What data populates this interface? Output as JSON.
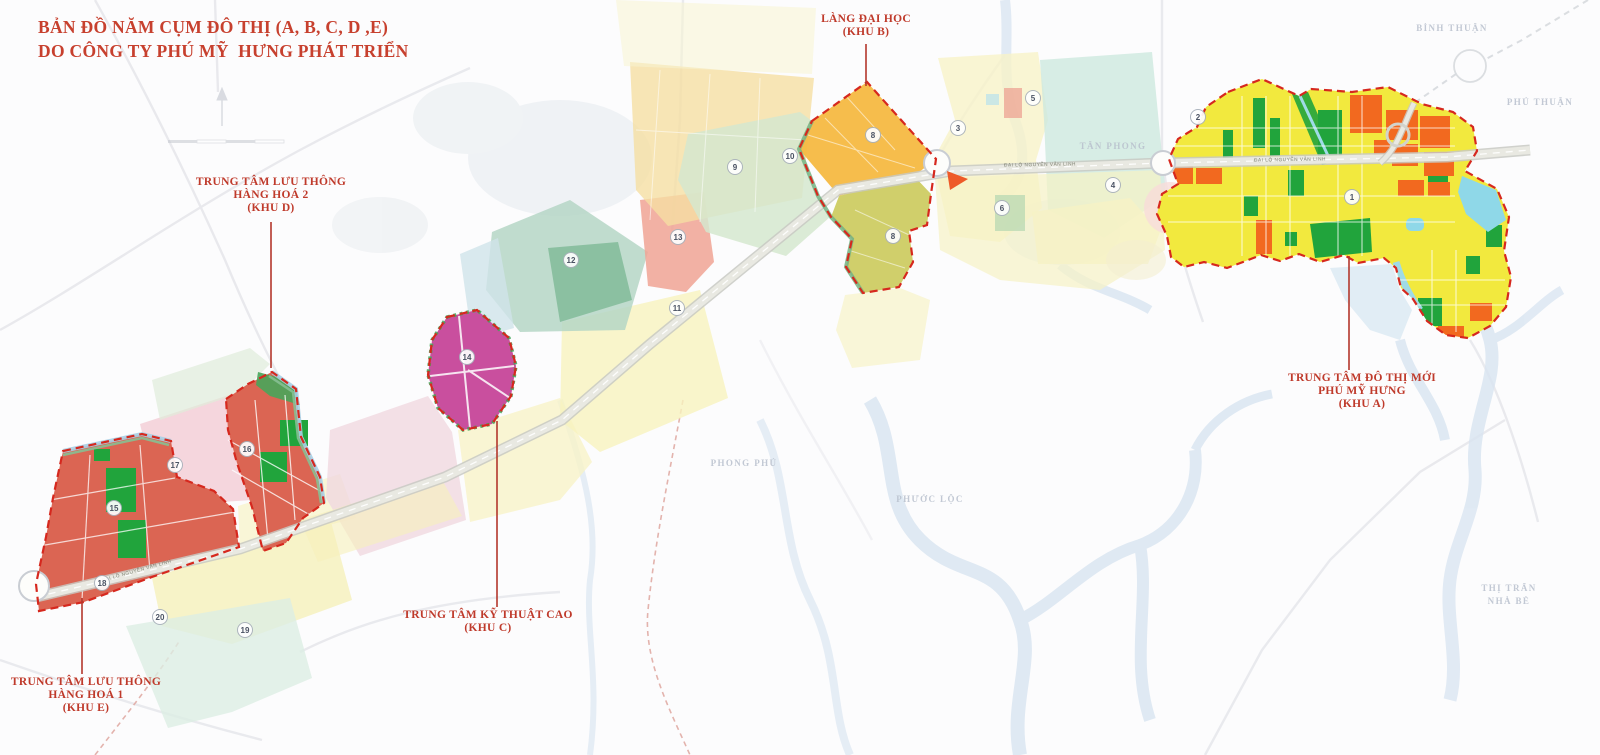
{
  "title": {
    "line1": "BẢN ĐỒ NĂM CỤM ĐÔ THỊ (A, B, C, D ,E)",
    "line2": "DO CÔNG TY PHÚ MỸ  HƯNG PHÁT TRIỂN"
  },
  "zone_labels": [
    {
      "id": "khu-b",
      "lines": [
        "LÀNG ĐẠI HỌC",
        "(KHU B)"
      ],
      "cx": 866,
      "top": 13,
      "leader": {
        "x": 866,
        "y1": 44,
        "y2": 86
      }
    },
    {
      "id": "khu-d",
      "lines": [
        "TRUNG TÂM LƯU THÔNG",
        "HÀNG HOÁ 2",
        "(KHU D)"
      ],
      "cx": 271,
      "top": 176,
      "leader": {
        "x": 271,
        "y1": 222,
        "y2": 368
      }
    },
    {
      "id": "khu-a",
      "lines": [
        "TRUNG TÂM ĐÔ THỊ MỚI",
        "PHÚ MỸ HƯNG",
        "(KHU A)"
      ],
      "cx": 1362,
      "top": 372,
      "leader": {
        "x": 1349,
        "y1": 256,
        "y2": 370
      }
    },
    {
      "id": "khu-c",
      "lines": [
        "TRUNG TÂM KỸ THUẬT CAO",
        "(KHU C)"
      ],
      "cx": 488,
      "top": 609,
      "leader": {
        "x": 497,
        "y1": 421,
        "y2": 607
      }
    },
    {
      "id": "khu-e",
      "lines": [
        "TRUNG TÂM LƯU THÔNG",
        "HÀNG HOÁ 1",
        "(KHU E)"
      ],
      "cx": 86,
      "top": 676,
      "leader": {
        "x": 82,
        "y1": 598,
        "y2": 674
      }
    }
  ],
  "district_names": [
    {
      "text": "BÌNH THUẬN",
      "x": 1452,
      "y": 28
    },
    {
      "text": "PHÚ THUẬN",
      "x": 1540,
      "y": 102
    },
    {
      "text": "TÂN PHONG",
      "x": 1113,
      "y": 146
    },
    {
      "text": "PHONG PHÚ",
      "x": 744,
      "y": 463
    },
    {
      "text": "PHƯỚC LỘC",
      "x": 930,
      "y": 499
    },
    {
      "text": "THỊ TRẤN",
      "x": 1509,
      "y": 588
    },
    {
      "text": "NHÀ BÈ",
      "x": 1509,
      "y": 601
    }
  ],
  "zone_markers": [
    {
      "n": "1",
      "x": 1352,
      "y": 197
    },
    {
      "n": "2",
      "x": 1198,
      "y": 117
    },
    {
      "n": "3",
      "x": 958,
      "y": 128
    },
    {
      "n": "4",
      "x": 1113,
      "y": 185
    },
    {
      "n": "5",
      "x": 1033,
      "y": 98
    },
    {
      "n": "6",
      "x": 1002,
      "y": 208
    },
    {
      "n": "8",
      "x": 873,
      "y": 135
    },
    {
      "n": "8",
      "x": 893,
      "y": 236
    },
    {
      "n": "9",
      "x": 735,
      "y": 167
    },
    {
      "n": "10",
      "x": 790,
      "y": 156
    },
    {
      "n": "11",
      "x": 677,
      "y": 308
    },
    {
      "n": "12",
      "x": 571,
      "y": 260
    },
    {
      "n": "13",
      "x": 678,
      "y": 237
    },
    {
      "n": "14",
      "x": 467,
      "y": 357
    },
    {
      "n": "15",
      "x": 114,
      "y": 508
    },
    {
      "n": "16",
      "x": 247,
      "y": 449
    },
    {
      "n": "17",
      "x": 175,
      "y": 465
    },
    {
      "n": "18",
      "x": 102,
      "y": 583
    },
    {
      "n": "19",
      "x": 245,
      "y": 630
    },
    {
      "n": "20",
      "x": 160,
      "y": 617
    }
  ],
  "road_labels": [
    {
      "text": "ĐẠI LỘ NGUYỄN VĂN LINH",
      "x": 137,
      "y": 572,
      "rotate": -15.5
    },
    {
      "text": "ĐẠI LỘ NGUYỄN VĂN LINH",
      "x": 1040,
      "y": 166,
      "rotate": -1
    },
    {
      "text": "ĐẠI LỘ NGUYỄN VĂN LINH",
      "x": 1290,
      "y": 161,
      "rotate": -1
    }
  ],
  "colors": {
    "title_red": "#c7402e",
    "label_red": "#bf3a2b",
    "zone_a_base": "#f2e93e",
    "zone_b_orange": "#f5b942",
    "zone_b_olive": "#cdcc63",
    "zone_c_magenta": "#c94f9e",
    "zone_de_red": "#db6553",
    "park_green": "#21a43c",
    "block_orange": "#f2691f",
    "water_cyan": "#8fd8e8",
    "border_dash_red": "#d6281e"
  }
}
